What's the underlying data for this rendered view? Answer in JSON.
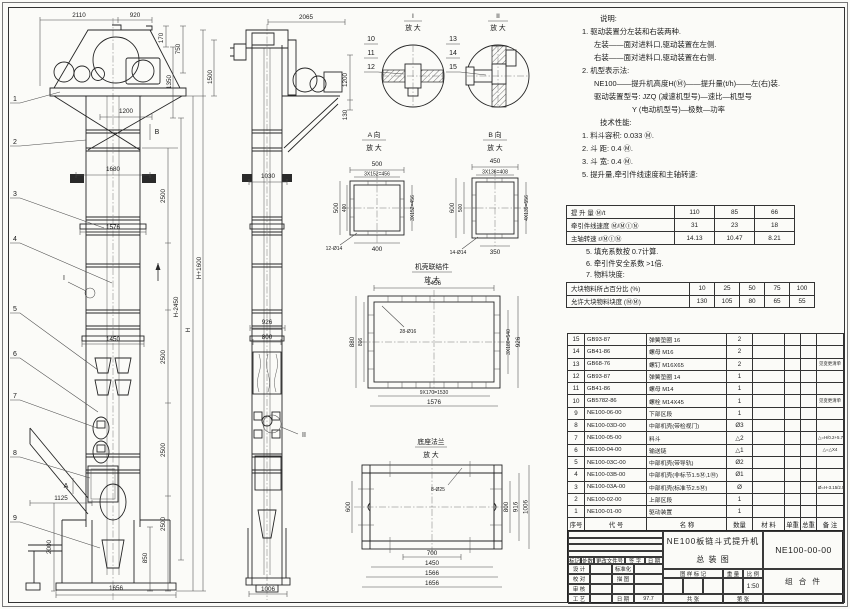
{
  "front_view": {
    "balloons": [
      "1",
      "2",
      "3",
      "4",
      "5",
      "6",
      "7",
      "8",
      "9"
    ],
    "marker_i": "I",
    "marker_a": "A",
    "marker_b": "B",
    "dims": {
      "top_w": "2110",
      "top_w2": "920",
      "h170": "170",
      "h750": "750",
      "h1350": "1350",
      "w1200": "1200",
      "w1680": "1680",
      "w1576": "1576",
      "w1450": "1450",
      "w1125": "1125",
      "h2000": "2000",
      "h850": "850",
      "w1656": "1656",
      "s1": "2500",
      "s2": "2500",
      "s3": "2500",
      "s4": "2500",
      "hm": "H-2450",
      "h": "H",
      "ht": "H+1600"
    }
  },
  "side_view": {
    "marker_ii": "II",
    "dims": {
      "w2065": "2065",
      "h1500": "1500",
      "h1200": "1200",
      "h130": "130",
      "w1030": "1030",
      "w926": "926",
      "w800": "800",
      "w1006": "1006"
    }
  },
  "details": {
    "i": {
      "title": "I",
      "sub": "放 大",
      "balloons": [
        "10",
        "11",
        "12"
      ]
    },
    "ii": {
      "title": "II",
      "sub": "放 大",
      "balloons": [
        "13",
        "14",
        "15"
      ]
    },
    "a": {
      "title": "A 向",
      "sub": "放 大",
      "dims": {
        "t1": "500",
        "t2": "3X152=456",
        "l1": "500",
        "l2": "400",
        "r1": "3X152=456",
        "b1": "400",
        "holes": "12-Ø14"
      }
    },
    "b": {
      "title": "B 向",
      "sub": "放 大",
      "dims": {
        "t1": "450",
        "t2": "3X136=408",
        "l1": "600",
        "l2": "500",
        "r1": "4X139=556",
        "b1": "350",
        "holes": "14-Ø14"
      }
    },
    "flange": {
      "title": "机壳联结件",
      "sub": "放 大",
      "dims": {
        "t1": "1456",
        "l1": "880",
        "l2": "806",
        "r1": "3X180=540",
        "r2": "926",
        "b1": "9X170=1530",
        "b2": "1576",
        "holes": "28-Ø16"
      }
    },
    "base": {
      "title": "底座法兰",
      "sub": "放 大",
      "dims": {
        "l1": "600",
        "r1": "800",
        "r2": "916",
        "r3": "1006",
        "b1": "700",
        "b2": "1450",
        "b3": "1566",
        "b4": "1656",
        "holes": "8-Ø25"
      }
    }
  },
  "notes": {
    "heading": "说明:",
    "lines": [
      "1. 驱动装置分左装和右装两种.",
      "左装——面对进料口,驱动装置在左侧.",
      "右装——面对进料口,驱动装置在右侧.",
      "2. 机型表示法:",
      "NE100——提升机高度H(Ⓜ)——提升量(t/h)——左(右)装.",
      "驱动装置型号: JZQ (减速机型号)—速比—机型号",
      "Y (电动机型号)—极数—功率"
    ]
  },
  "tech": {
    "heading": "技术性能:",
    "lines": [
      "1. 料斗容积: 0.033 Ⓜ.",
      "2. 斗  距: 0.4 Ⓜ.",
      "3. 斗  宽: 0.4 Ⓜ.",
      "5. 提升量,牵引件线速度和主轴转速:"
    ]
  },
  "perf_table": {
    "rows": [
      [
        "提 升 量  Ⓜ/t",
        "110",
        "85",
        "66"
      ],
      [
        "牵引件线速度  Ⓜ/ⓂⒾⓃ",
        "31",
        "23",
        "18"
      ],
      [
        "主轴转速  r/ⓂⒾⓃ",
        "14.13",
        "10.47",
        "8.21"
      ]
    ]
  },
  "notes2": {
    "lines": [
      "5. 填充系数按 0.7计算.",
      "6. 牵引件安全系数 >1倍.",
      "7. 物料块度:"
    ]
  },
  "lump_table": {
    "rows": [
      [
        "大块物料所占百分比 (%)",
        "10",
        "25",
        "50",
        "75",
        "100"
      ],
      [
        "允许大块物料块度 (ⓂⓂ)",
        "130",
        "105",
        "80",
        "65",
        "55"
      ]
    ]
  },
  "bom": {
    "rows": [
      [
        "15",
        "GB93-87",
        "弹簧垫圈 16",
        "2",
        "",
        "",
        "",
        ""
      ],
      [
        "14",
        "GB41-86",
        "螺母 M16",
        "2",
        "",
        "",
        "",
        ""
      ],
      [
        "13",
        "GB68-76",
        "螺钉 M16X65",
        "2",
        "",
        "",
        "",
        "见变更清单"
      ],
      [
        "12",
        "GB93-87",
        "弹簧垫圈 14",
        "1",
        "",
        "",
        "",
        ""
      ],
      [
        "11",
        "GB41-86",
        "螺母 M14",
        "1",
        "",
        "",
        "",
        ""
      ],
      [
        "10",
        "GB5782-86",
        "螺栓 M14X45",
        "1",
        "",
        "",
        "",
        "见变更清单"
      ],
      [
        "9",
        "NE100-06-00",
        "下部区段",
        "1",
        "",
        "",
        "",
        ""
      ],
      [
        "8",
        "NE100-03D-00",
        "中部机壳(带检视门)",
        "Ø3",
        "",
        "",
        "",
        ""
      ],
      [
        "7",
        "NE100-05-00",
        "料斗",
        "△2",
        "",
        "",
        "",
        "△=H/0.2+5.75"
      ],
      [
        "6",
        "NE100-04-00",
        "输送链",
        "△1",
        "",
        "",
        "",
        "△=△X4"
      ],
      [
        "5",
        "NE100-03C-00",
        "中部机壳(带导轨)",
        "Ø2",
        "",
        "",
        "",
        ""
      ],
      [
        "4",
        "NE100-03B-00",
        "中部机壳(非标节1.5Ⓜ,1Ⓜ)",
        "Ø1",
        "",
        "",
        "",
        ""
      ],
      [
        "3",
        "NE100-03A-00",
        "中部机壳(标准节2.5Ⓜ)",
        "Ø",
        "",
        "",
        "",
        "Ø=H-3.15/2.5"
      ],
      [
        "2",
        "NE100-02-00",
        "上部区段",
        "1",
        "",
        "",
        "",
        ""
      ],
      [
        "1",
        "NE100-01-00",
        "驱动装置",
        "1",
        "",
        "",
        "",
        ""
      ],
      [
        "序号",
        "代  号",
        "名    称",
        "数量",
        "材  料",
        "单重",
        "总重",
        "备  注"
      ]
    ]
  },
  "title_block": {
    "rev_headers": [
      "标记",
      "处数",
      "更改文件号",
      "签 字",
      "日 期"
    ],
    "row1_l": "设 计",
    "row1_r": "标准化",
    "row2_l": "校 对",
    "row2_r": "描 图",
    "row3_l": "审 核",
    "row3_r": "",
    "row4_l": "工 艺",
    "row4_r": "日 期",
    "date": "97.7",
    "title_line1": "NE100板链斗式提升机",
    "title_line2": "总  装  图",
    "mark_h": "图 样 标 记",
    "weight_h": "重 量",
    "scale_h": "比 例",
    "scale": "1:50",
    "sheet_l": "共  张",
    "sheet_r": "第  张",
    "drawing_no": "NE100-00-00",
    "part_class": "组 合 件"
  }
}
